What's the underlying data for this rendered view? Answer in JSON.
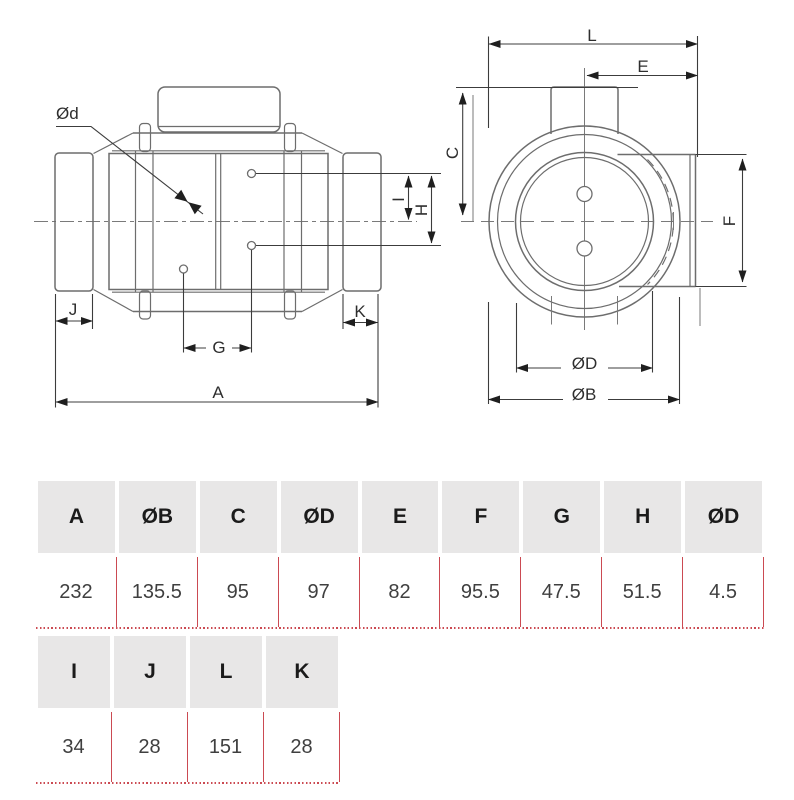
{
  "page": {
    "background": "#ffffff"
  },
  "drawing": {
    "side_view_labels": {
      "od": "Ød",
      "j": "J",
      "g": "G",
      "k": "K",
      "a": "A",
      "i": "I",
      "h": "H"
    },
    "front_view_labels": {
      "l": "L",
      "e": "E",
      "c": "C",
      "f": "F",
      "od": "ØD",
      "ob": "ØB"
    }
  },
  "tables": [
    {
      "columns": [
        "A",
        "ØB",
        "C",
        "ØD",
        "E",
        "F",
        "G",
        "H",
        "ØD"
      ],
      "values": [
        "232",
        "135.5",
        "95",
        "97",
        "82",
        "95.5",
        "47.5",
        "51.5",
        "4.5"
      ]
    },
    {
      "columns": [
        "I",
        "J",
        "L",
        "K"
      ],
      "values": [
        "34",
        "28",
        "151",
        "28"
      ]
    }
  ],
  "colors": {
    "accent_red": "#cb4a52",
    "header_bg": "#e8e7e7",
    "drawing_line": "#6d6d6d",
    "dimension_line": "#3c3c3c",
    "header_text": "#1b1b1b",
    "value_text": "#3f3f3f"
  }
}
